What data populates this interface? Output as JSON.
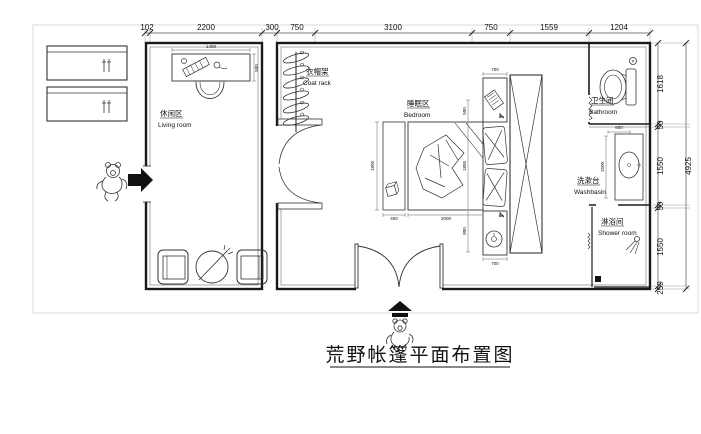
{
  "title": "荒野帐篷平面布置图",
  "rooms": {
    "living": {
      "zh": "休闲区",
      "en": "Living room"
    },
    "coatrack": {
      "zh": "衣帽架",
      "en": "Coat rack"
    },
    "bedroom": {
      "zh": "睡眠区",
      "en": "Bedroom"
    },
    "bathroom": {
      "zh": "卫生间",
      "en": "Bathroom"
    },
    "washbasin": {
      "zh": "洗漱台",
      "en": "Washbasin"
    },
    "shower": {
      "zh": "淋浴间",
      "en": "Shower room"
    }
  },
  "dims": {
    "top": [
      "102",
      "2200",
      "300",
      "750",
      "3100",
      "750",
      "1559",
      "1204"
    ],
    "right": [
      "1618",
      "50",
      "1550",
      "50",
      "1550",
      "250"
    ],
    "right_total": "4925",
    "detail": {
      "desk_width": "1400",
      "desk_depth": "500",
      "bed_width": "2000",
      "bench_width": "450",
      "bed_length": "1800",
      "side_upper": "500",
      "side_lower": "800",
      "nightstand_width": "700",
      "bathroom_door": "600",
      "basin_counter": "1500"
    }
  },
  "colors": {
    "background": "#ffffff",
    "wall_line": "#1a1a1a",
    "dim_line": "#444444",
    "frame": "#d9d9d9"
  }
}
